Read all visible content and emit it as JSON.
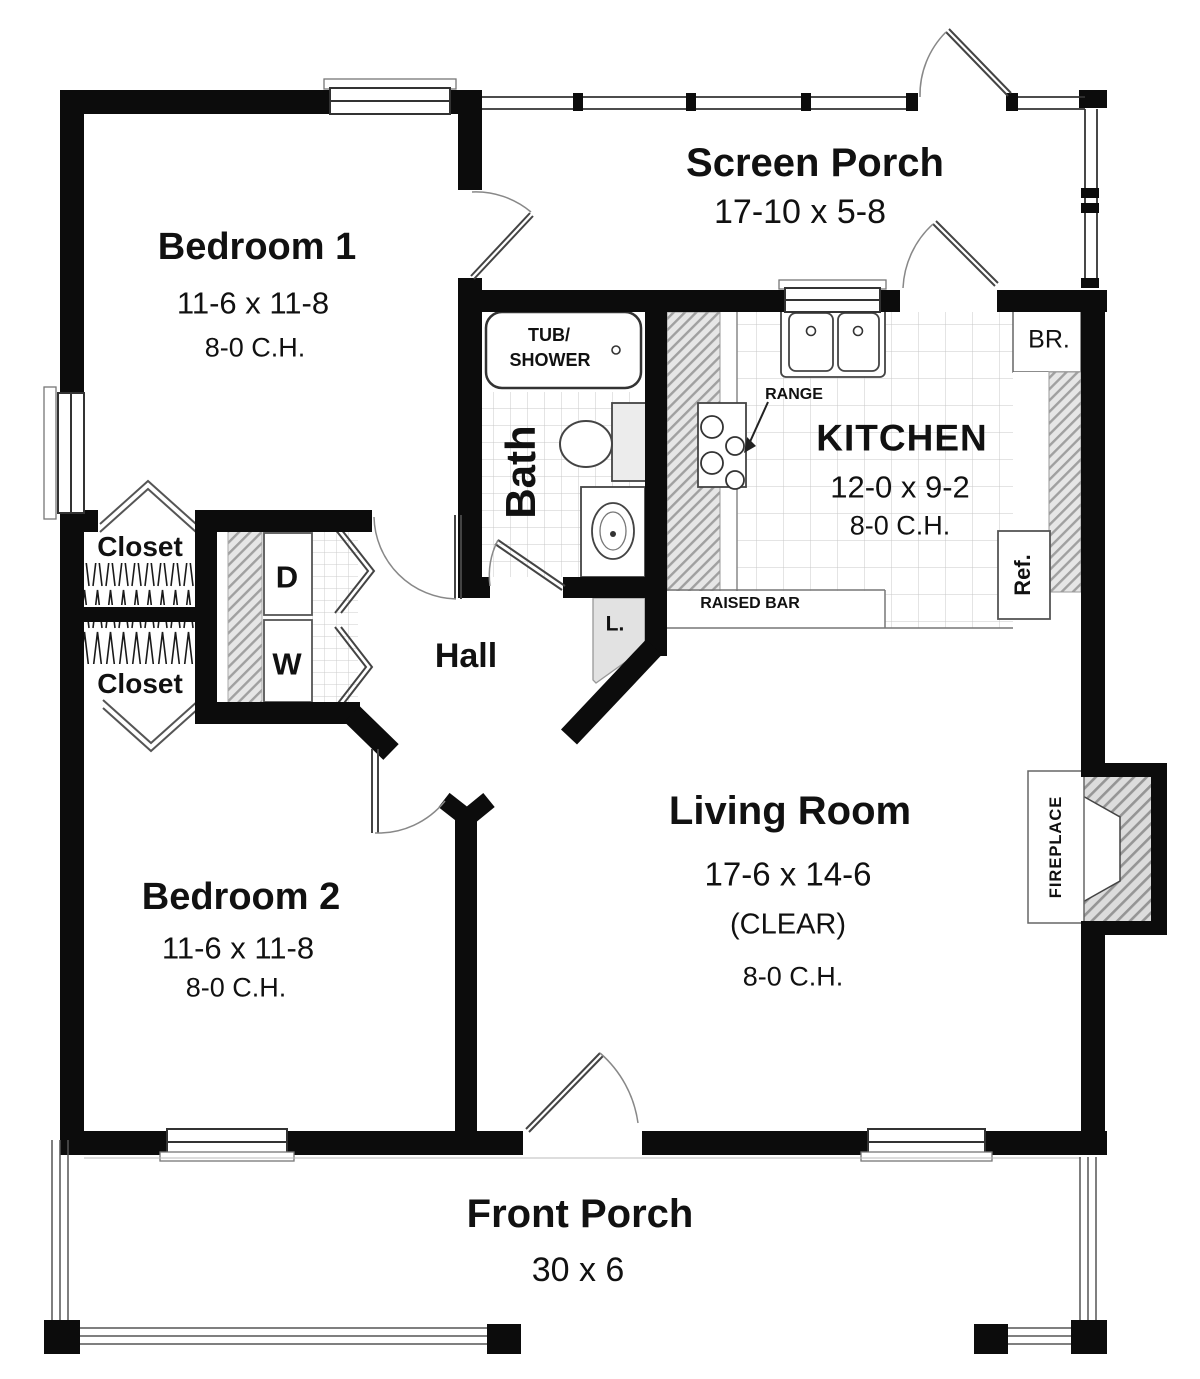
{
  "title": "House floor plan",
  "rooms": {
    "bedroom1": {
      "name": "Bedroom 1",
      "dims": "11-6 x 11-8",
      "ceiling": "8-0 C.H."
    },
    "screen_porch": {
      "name": "Screen Porch",
      "dims": "17-10 x 5-8"
    },
    "kitchen": {
      "name": "KITCHEN",
      "dims": "12-0 x 9-2",
      "ceiling": "8-0 C.H."
    },
    "bath": {
      "name": "Bath"
    },
    "hall": {
      "name": "Hall"
    },
    "living_room": {
      "name": "Living Room",
      "dims": "17-6 x 14-6",
      "clear": "(CLEAR)",
      "ceiling": "8-0 C.H."
    },
    "bedroom2": {
      "name": "Bedroom 2",
      "dims": "11-6 x 11-8",
      "ceiling": "8-0 C.H."
    },
    "front_porch": {
      "name": "Front Porch",
      "dims": "30 x 6"
    }
  },
  "closets": {
    "upper": "Closet",
    "lower": "Closet",
    "linen": "L.",
    "broom": "BR."
  },
  "fixtures": {
    "tub_line1": "TUB/",
    "tub_line2": "SHOWER",
    "range": "RANGE",
    "raised_bar": "RAISED BAR",
    "refrigerator": "Ref.",
    "dryer": "D",
    "washer": "W",
    "fireplace": "FIREPLACE"
  },
  "colors": {
    "wall": "#0c0c0c",
    "hatch_fill": "#e6e6e6",
    "hatch_line": "#a0a0a0",
    "tile_line": "#c9c9c9",
    "text": "#111111",
    "background": "#ffffff"
  }
}
